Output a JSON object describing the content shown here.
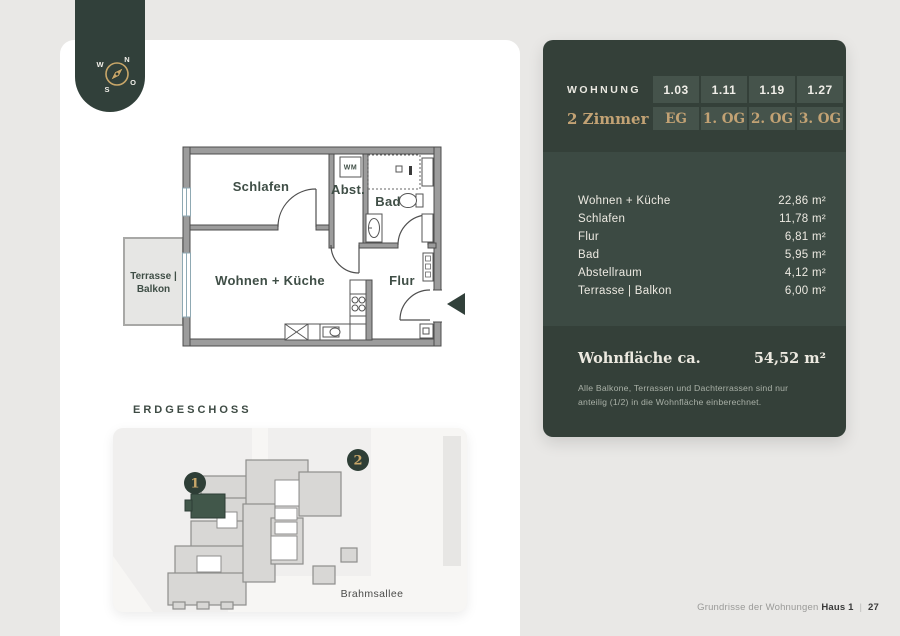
{
  "compass": {
    "n": "N",
    "o": "O",
    "s": "S",
    "w": "W"
  },
  "floor_plan": {
    "floor_label": "ERDGESCHOSS",
    "rooms": {
      "schlafen": "Schlafen",
      "abst": "Abst.",
      "bad": "Bad",
      "wohnen": "Wohnen + Küche",
      "flur": "Flur",
      "wm": "WM",
      "terrasse_line1": "Terrasse |",
      "terrasse_line2": "Balkon"
    }
  },
  "site_plan": {
    "badge_house1": "1",
    "badge_house2": "2",
    "street": "Brahmsallee"
  },
  "panel": {
    "wohnung_label": "WOHNUNG",
    "zimmer_label": "2 Zimmer",
    "units": [
      "1.03",
      "1.11",
      "1.19",
      "1.27"
    ],
    "floors": [
      "EG",
      "1. OG",
      "2. OG",
      "3. OG"
    ],
    "rooms": [
      {
        "label": "Wohnen + Küche",
        "area": "22,86 m²"
      },
      {
        "label": "Schlafen",
        "area": "11,78 m²"
      },
      {
        "label": "Flur",
        "area": "6,81 m²"
      },
      {
        "label": "Bad",
        "area": "5,95 m²"
      },
      {
        "label": "Abstellraum",
        "area": "4,12 m²"
      },
      {
        "label": "Terrasse | Balkon",
        "area": "6,00 m²"
      }
    ],
    "total_label": "Wohnfläche ca.",
    "total_area": "54,52 m²",
    "note_line1": "Alle Balkone, Terrassen und Dachterrassen sind nur",
    "note_line2": "anteilig (1/2) in die Wohnfläche einberechnet."
  },
  "footer": {
    "text": "Grundrisse der Wohnungen",
    "house": "Haus 1",
    "separator": "|",
    "page_number": "27"
  },
  "colors": {
    "background": "#e9e8e6",
    "sheet": "#ffffff",
    "green_dark": "#344039",
    "green_body": "#3c4a43",
    "green_cell": "#45534b",
    "gold": "#c2a274",
    "cream": "#edeae2",
    "highlight_unit": "#41574a"
  }
}
